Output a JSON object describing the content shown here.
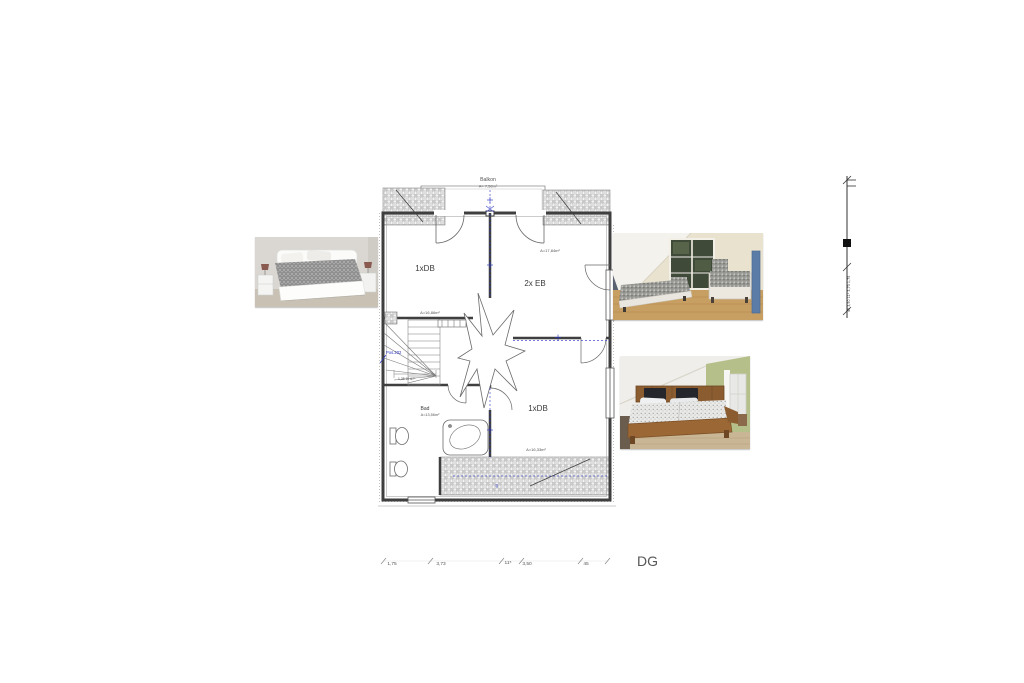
{
  "plan": {
    "floor_label": "DG",
    "balcony": {
      "name": "Balkon",
      "area": "A= 7,58m²"
    },
    "rooms": {
      "top_left": {
        "name": "1xDB",
        "area": "A=16,86m²"
      },
      "top_right": {
        "name": "2x EB",
        "area": "A=17,84m²"
      },
      "bottom_right": {
        "name": "1xDB",
        "area": "A=16,33m²"
      },
      "bath": {
        "name": "Bad",
        "area": "A=13,56m²"
      }
    },
    "annotations": {
      "position_label": "Pos.202",
      "stair_dimensions": "1,35 10 67⁵",
      "hatch_width_label": "40"
    },
    "dims_bottom": [
      "1,75",
      "3,73",
      "11⁵",
      "3,50",
      "45"
    ],
    "dims_right_chain": "45 3,50 11⁵ 3,73 1,75",
    "colors": {
      "annotation_blue": "#2a35c0",
      "drawing_line": "#3f3f3f",
      "hatch_gray": "#9a9a9a"
    }
  },
  "photos": {
    "left": {
      "label": "bedroom-white-double-bed"
    },
    "top_right": {
      "label": "bedroom-two-single-beds"
    },
    "mid_right": {
      "label": "bedroom-wooden-double-bed"
    }
  }
}
